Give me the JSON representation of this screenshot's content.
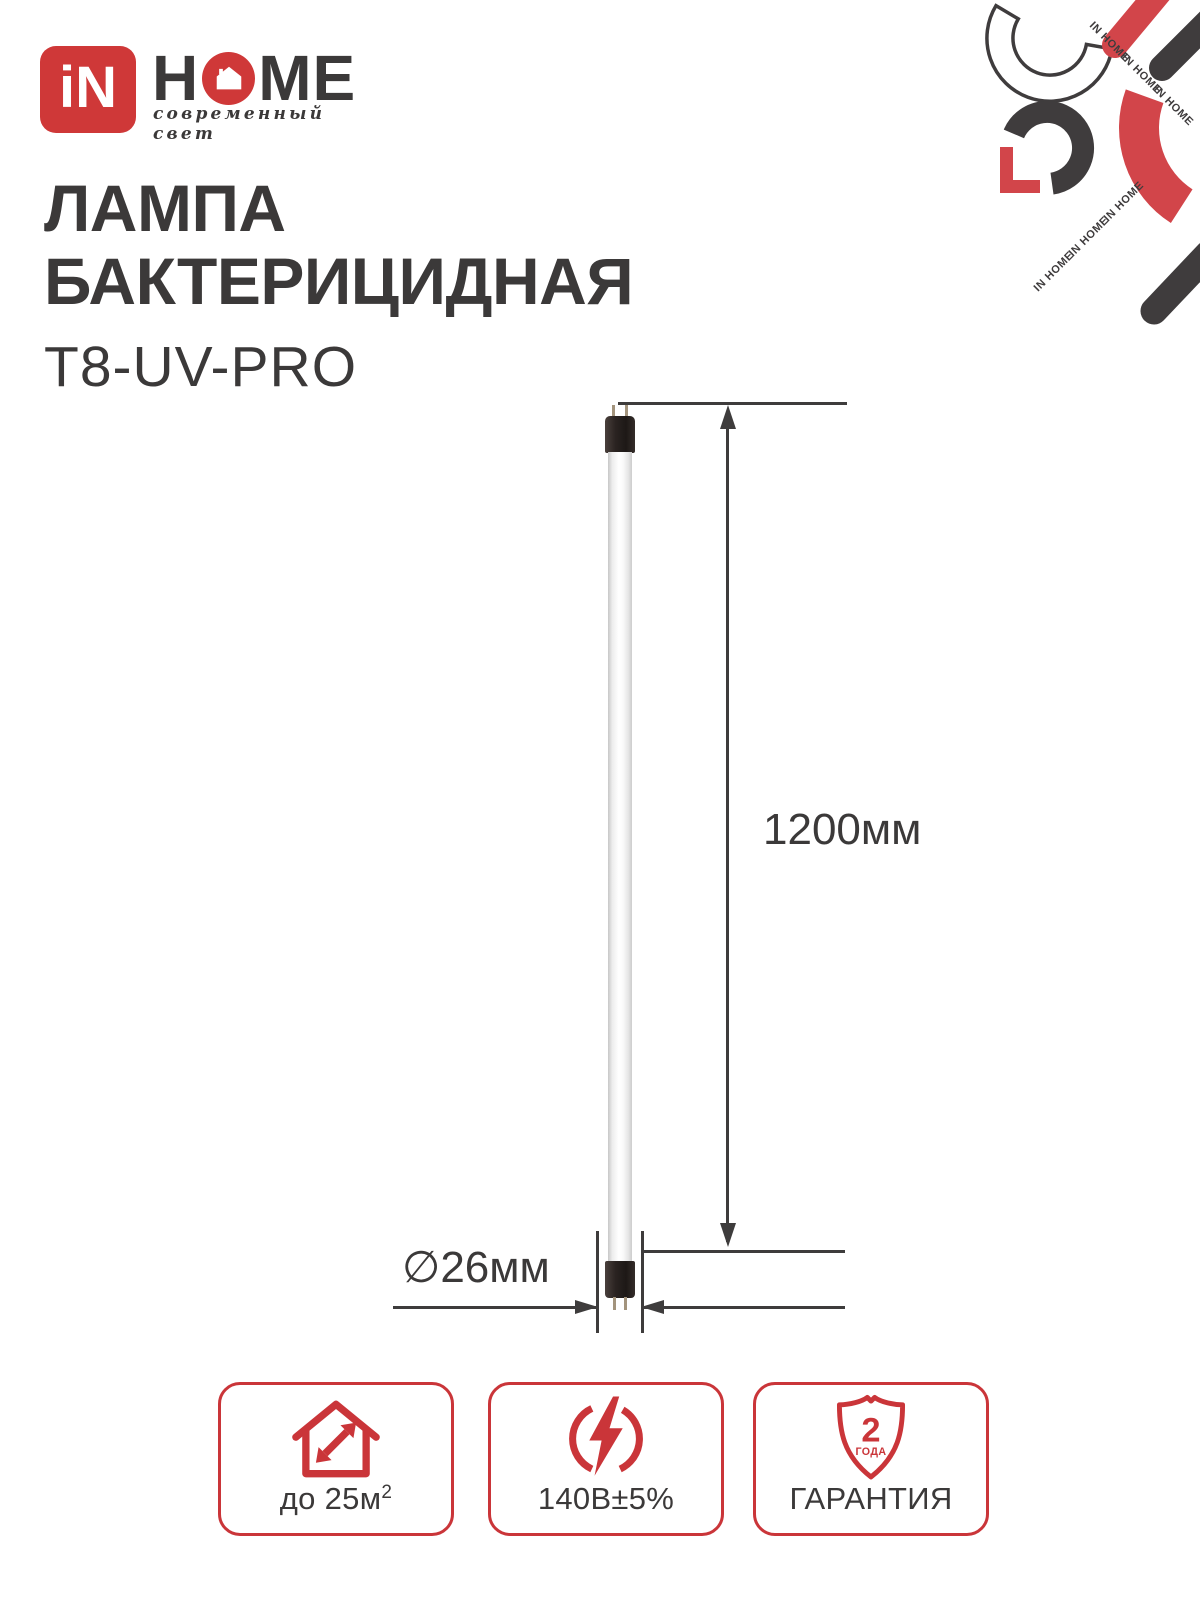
{
  "brand": {
    "logo_text": "iN",
    "home_first": "H",
    "home_rest": "ME",
    "tagline": "современный свет"
  },
  "pattern": {
    "text": "IN HOME"
  },
  "product": {
    "title_line1": "ЛАМПА",
    "title_line2": "БАКТЕРИЦИДНАЯ",
    "model": "T8-UV-PRO"
  },
  "diagram": {
    "length_label": "1200мм",
    "diameter_label": "∅26мм"
  },
  "features": {
    "area": {
      "icon": "house-expand-icon",
      "text": "до 25м",
      "sup": "2"
    },
    "voltage": {
      "icon": "lightning-circle-icon",
      "text": "140В±5%"
    },
    "warranty": {
      "icon": "shield-warranty-icon",
      "years": "2",
      "unit": "ГОДА",
      "text": "ГАРАНТИЯ"
    }
  },
  "colors": {
    "brand_red": "#cf3838",
    "feature_red": "#ca3539",
    "pattern_red": "#d2454a",
    "dark": "#3b3939"
  }
}
